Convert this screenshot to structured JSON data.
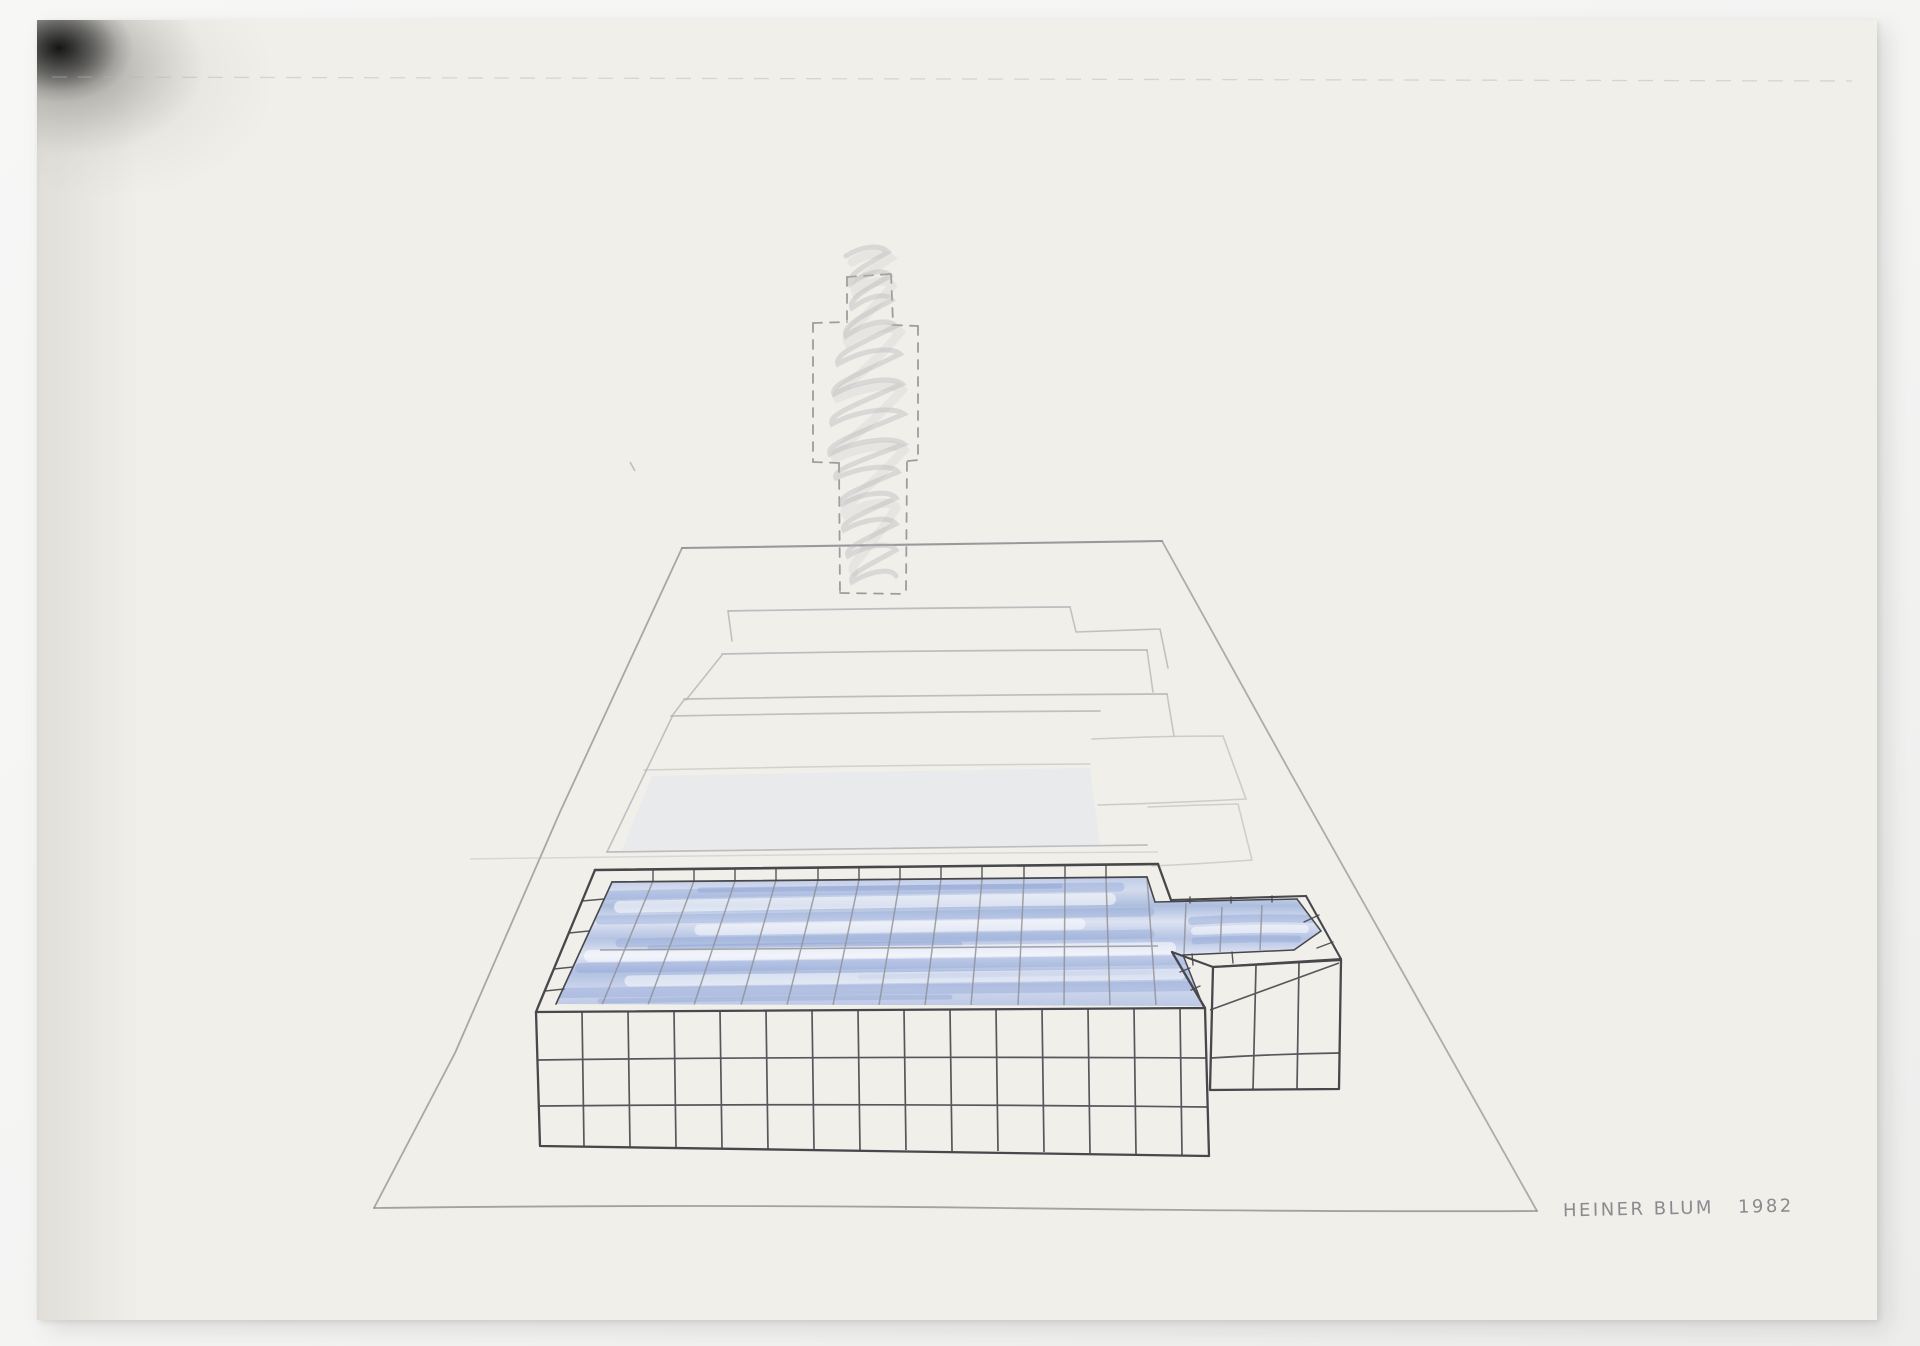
{
  "artwork": {
    "signature": {
      "artist": "HEINER BLUM",
      "year": "1982"
    }
  },
  "colors": {
    "backdrop": "#f4f4f3",
    "paper": "#f0efe9",
    "pencil_dark": "#47474c",
    "pencil_mid": "#8f8f94",
    "pencil_faint": "#b4b4b8",
    "signature_gray": "#82828a",
    "water_base": "#c3cfe8",
    "water_streak": "#8fa5d6",
    "water_deep": "#7b93cb",
    "water_light": "#ffffff",
    "slab_tint": "#dce4f1",
    "spray_black": "#0a0a0a"
  }
}
